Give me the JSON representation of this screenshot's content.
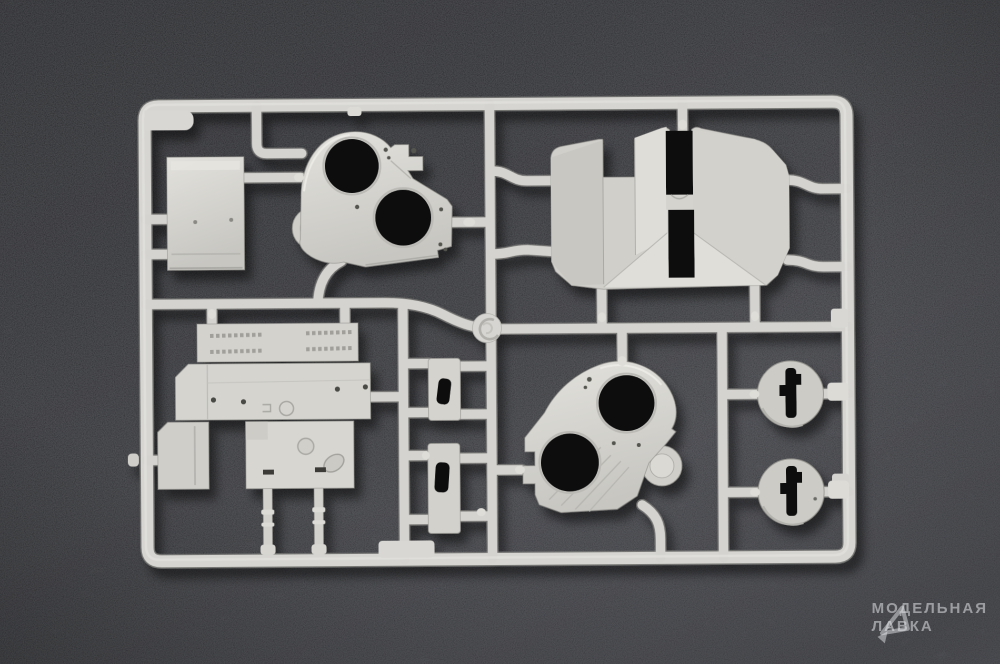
{
  "scene": {
    "type": "photograph",
    "subject": "Light-grey injection-moulded scale-model sprue with unassembled parts, lying on dark flocked (felt) background",
    "plastic_color": "#d6d5d1",
    "plastic_highlight": "#e8e7e2",
    "plastic_shade": "#a8a7a2",
    "hole_color": "#0b0b0d",
    "background_top": "#1e1f22",
    "background_bottom": "#575960"
  },
  "watermark": {
    "line1": "МОДЕЛЬНАЯ",
    "line2": "ЛАВКА",
    "icon": "cursor-triangle-logo",
    "color": "rgba(226,227,231,0.55)"
  },
  "parts": [
    {
      "id": "sprue-frame",
      "label": "Rectangular sprue frame with runners"
    },
    {
      "id": "box-part",
      "label": "Rectangular box part (top left)"
    },
    {
      "id": "turret-housing-upper",
      "label": "Housing part with two large round openings (top centre)"
    },
    {
      "id": "hull-roof-part",
      "label": "Angled roof slab part with centre channel (top right)"
    },
    {
      "id": "panel-assembly",
      "label": "Flat hull panel group with grille and hatch details (lower left)"
    },
    {
      "id": "rod-left",
      "label": "Thin rod part, left"
    },
    {
      "id": "rod-right",
      "label": "Thin rod part, right"
    },
    {
      "id": "bracket-small",
      "label": "Small slotted bracket part"
    },
    {
      "id": "bracket-large",
      "label": "Large slotted bracket part"
    },
    {
      "id": "turret-housing-lower",
      "label": "Housing part with two large round openings (bottom centre)"
    },
    {
      "id": "disc-upper",
      "label": "Round disc part with keyed slot, upper right"
    },
    {
      "id": "disc-lower",
      "label": "Round disc part with keyed slot, lower right"
    },
    {
      "id": "injection-node",
      "label": "Round injection gate node with swirl mark"
    }
  ]
}
